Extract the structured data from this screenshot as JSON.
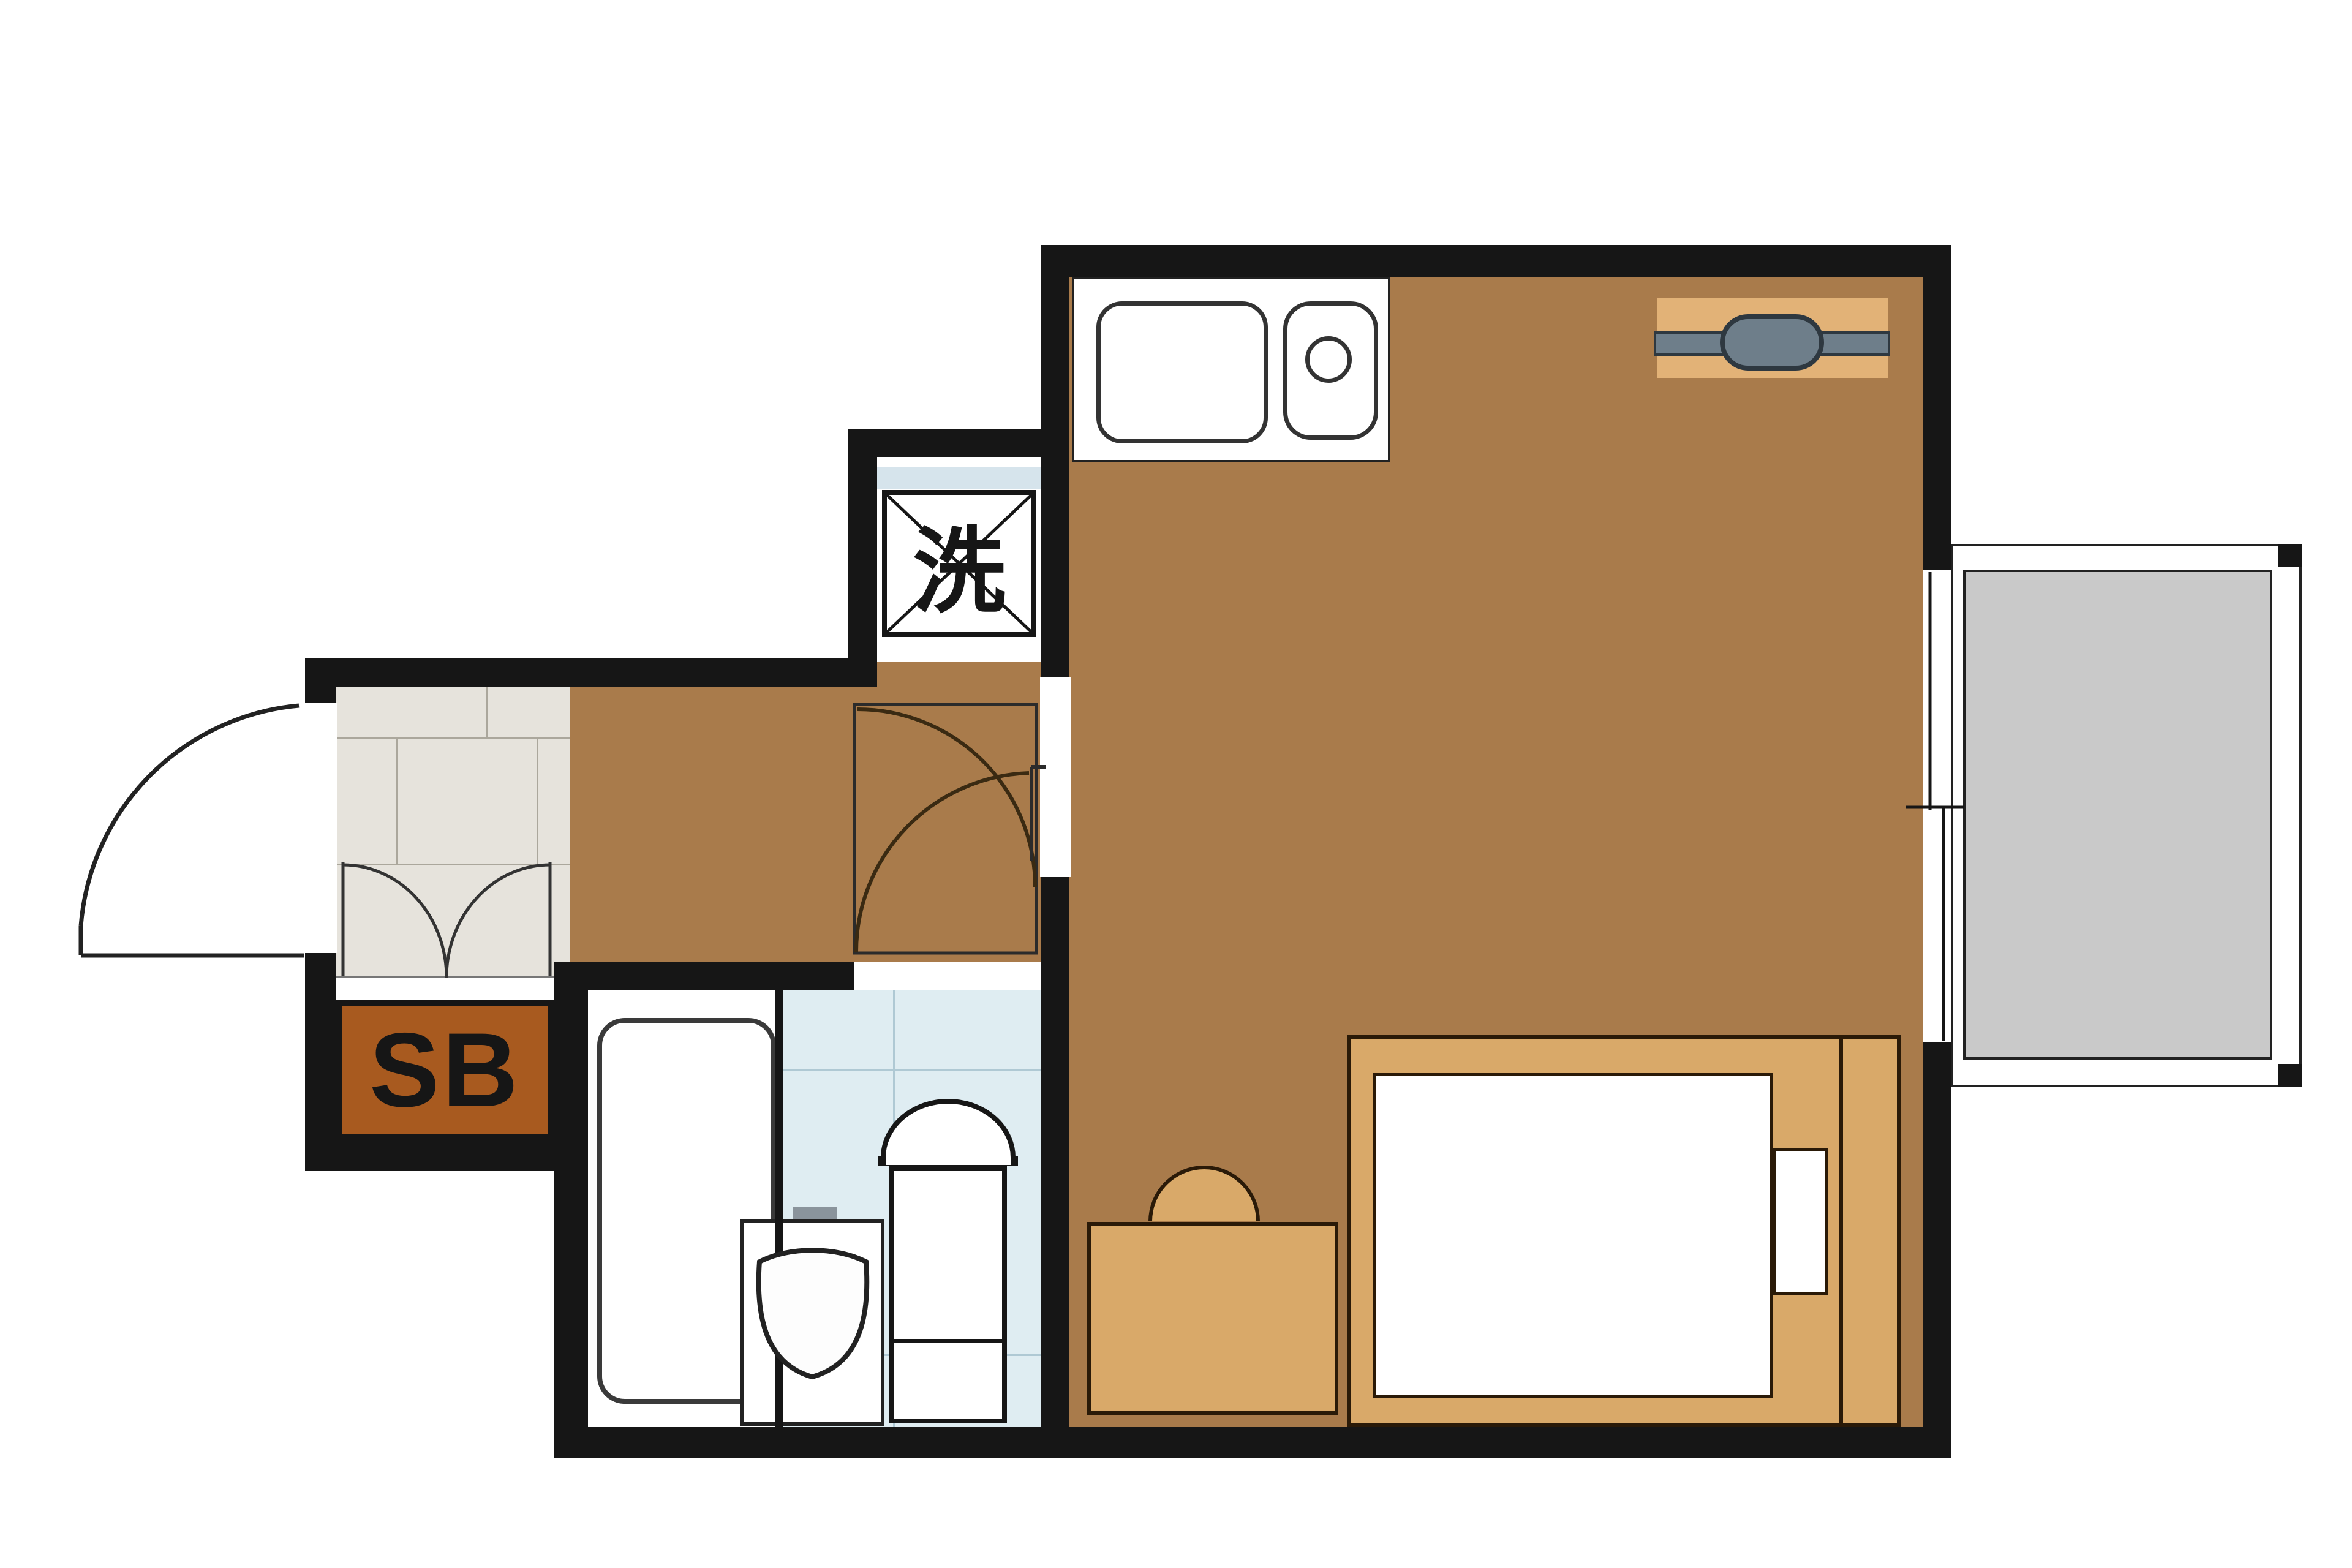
{
  "plan_type": "apartment-floor-plan",
  "labels": {
    "washing_machine": "洗",
    "shoe_box": "SB"
  },
  "colors": {
    "wall": "#161616",
    "floor": "#A97B4B",
    "furniture": "#D9A969",
    "hanger-bar": "#E2B277",
    "pipe": "#6E7E8A",
    "pipe-dark": "#2E3840",
    "shoebox": "#A85A1F",
    "genkan-tile": "#E6E3DC",
    "genkan-grid": "#ABA79C",
    "bath-tile": "#DFEDF2",
    "bath-grid": "#AFC9D4",
    "wash-strip": "#D6E4EC",
    "balcony": "#C9C9C9",
    "outline": "#2A1A08"
  }
}
